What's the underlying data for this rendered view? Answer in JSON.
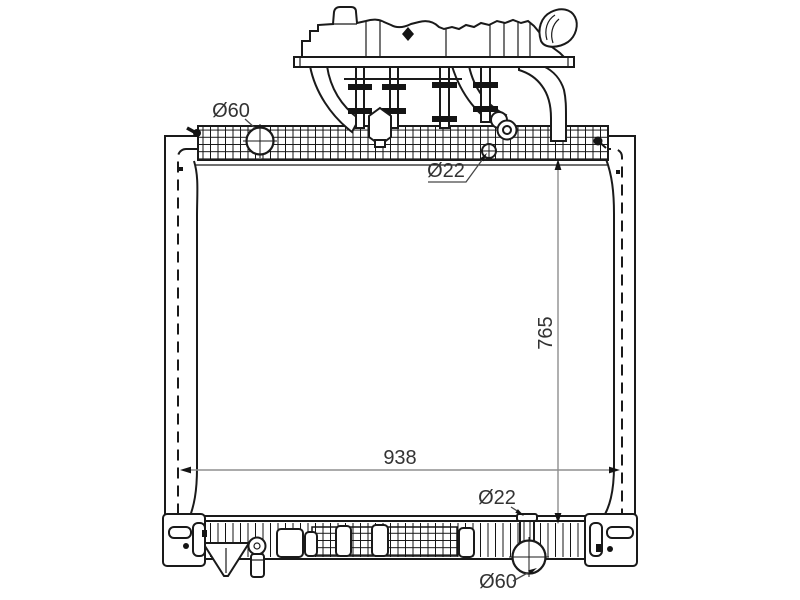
{
  "labels": {
    "top_port_diameter": "Ø60",
    "top_fitting_diameter": "Ø22",
    "core_height": "765",
    "core_width": "938",
    "bottom_fitting_diameter": "Ø22",
    "bottom_port_diameter": "Ø60"
  },
  "colors": {
    "ink": "#1a1a1a",
    "dimension_line": "#8f8f8f",
    "label_text": "#333333",
    "background": "#ffffff"
  }
}
